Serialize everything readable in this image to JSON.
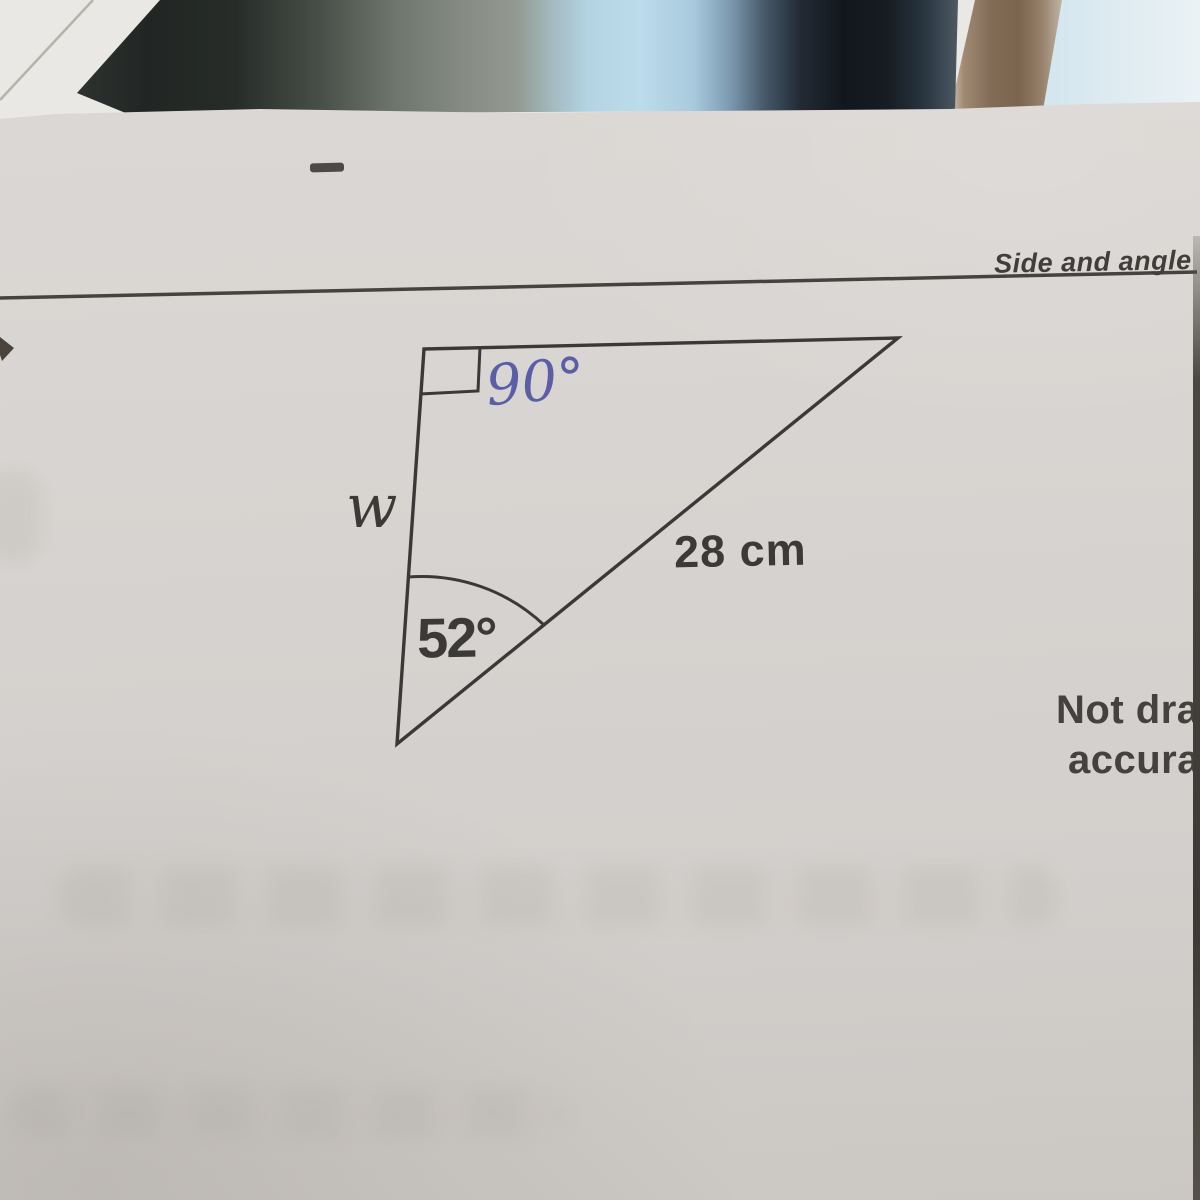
{
  "page": {
    "title": "Side and angle"
  },
  "triangle": {
    "right_angle_label": "90°",
    "base_angle_label": "52°",
    "side_label": "w",
    "hypotenuse_label": "28 cm"
  },
  "note": {
    "line1": "Not drawn",
    "line2": "accurately"
  },
  "colors": {
    "ink_blue": "#5b5ea6",
    "print_ink": "#3b3a37",
    "paper": "#d8d4d1"
  }
}
